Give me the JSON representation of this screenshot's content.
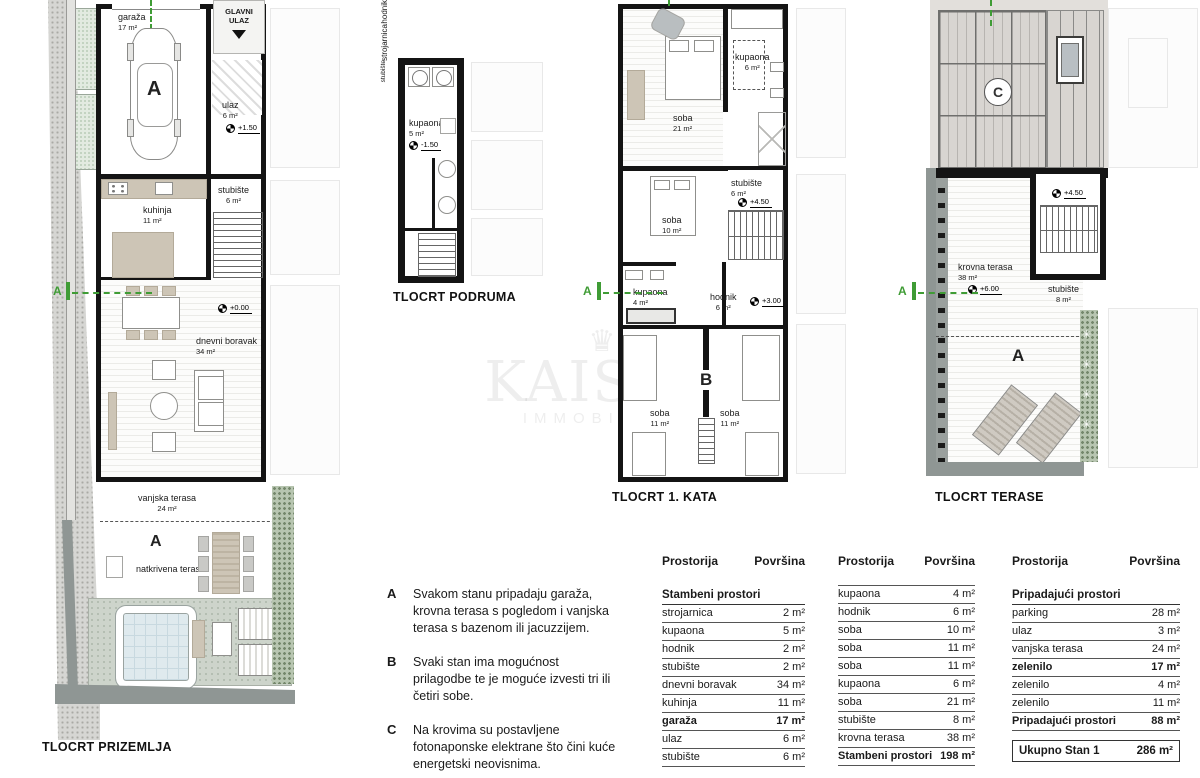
{
  "watermark": {
    "brand": "KAISER",
    "sub": "IMMOBILIEN",
    "crown": "♛"
  },
  "section_label": "A",
  "plans": {
    "prizemlje": {
      "caption": "TLOCRT PRIZEMLJA",
      "glavni_ulaz_line1": "GLAVNI",
      "glavni_ulaz_line2": "ULAZ",
      "unit_label": "A",
      "garaza_name": "garaža",
      "garaza_area": "17 m²",
      "ulaz_name": "ulaz",
      "ulaz_area": "6 m²",
      "ulaz_level": "+1.50",
      "stubiste_name": "stubište",
      "stubiste_area": "6 m²",
      "kuhinja_name": "kuhinja",
      "kuhinja_area": "11 m²",
      "dnevni_name": "dnevni boravak",
      "dnevni_area": "34 m²",
      "dnevni_level": "+0.00",
      "vanjska_name": "vanjska terasa",
      "vanjska_area": "24 m²",
      "natkrivena_name": "natkrivena terasa",
      "terasa_unit_label": "A"
    },
    "podrum": {
      "caption": "TLOCRT PODRUMA",
      "kupaona_name": "kupaona",
      "kupaona_area": "5 m²",
      "kupaona_level": "-1.50",
      "hodnik_name": "hodnik",
      "strojarnica_name": "strojarnica",
      "stubiste_name": "stubište"
    },
    "kat1": {
      "caption": "TLOCRT 1. KATA",
      "soba21_name": "soba",
      "soba21_area": "21 m²",
      "kupaona6_name": "kupaona",
      "kupaona6_area": "6 m²",
      "soba10_name": "soba",
      "soba10_area": "10 m²",
      "stubiste_name": "stubište",
      "stubiste_area": "6 m²",
      "stubiste_level": "+4.50",
      "kupaona4_name": "kupaona",
      "kupaona4_area": "4 m²",
      "hodnik_name": "hodnik",
      "hodnik_area": "6 m²",
      "hodnik_level": "+3.00",
      "variant_label": "B",
      "soba11a_name": "soba",
      "soba11a_area": "11 m²",
      "soba11b_name": "soba",
      "soba11b_area": "11 m²"
    },
    "terasa": {
      "caption": "TLOCRT TERASE",
      "roof_label": "C",
      "stubiste_level": "+4.50",
      "krovna_name": "krovna terasa",
      "krovna_area": "38 m²",
      "krovna_level": "+6.00",
      "stubiste_name": "stubište",
      "stubiste_area": "8 m²",
      "unit_label": "A"
    }
  },
  "notes": [
    {
      "key": "A",
      "text": "Svakom stanu pripadaju garaža, krovna terasa s pogledom i vanjska terasa s bazenom ili jacuzzijem."
    },
    {
      "key": "B",
      "text": "Svaki stan ima mogućnost prilagodbe te je moguće izvesti tri ili četiri sobe."
    },
    {
      "key": "C",
      "text": "Na krovima su postavljene fotonaponske elektrane što čini kuće energetski neovisnima."
    }
  ],
  "tables": [
    {
      "col1": "Prostorija",
      "col2": "Površina",
      "section": "Stambeni prostori",
      "rows": [
        {
          "label": "strojarnica",
          "value": "2 m²"
        },
        {
          "label": "kupaona",
          "value": "5 m²"
        },
        {
          "label": "hodnik",
          "value": "2 m²"
        },
        {
          "label": "stubište",
          "value": "2 m²"
        },
        {
          "label": "dnevni boravak",
          "value": "34 m²"
        },
        {
          "label": "kuhinja",
          "value": "11 m²"
        },
        {
          "label": "garaža",
          "value": "17 m²",
          "bold": true
        },
        {
          "label": "ulaz",
          "value": "6 m²"
        },
        {
          "label": "stubište",
          "value": "6 m²"
        }
      ]
    },
    {
      "col1": "Prostorija",
      "col2": "Površina",
      "rows": [
        {
          "label": "kupaona",
          "value": "4 m²"
        },
        {
          "label": "hodnik",
          "value": "6 m²"
        },
        {
          "label": "soba",
          "value": "10 m²"
        },
        {
          "label": "soba",
          "value": "11 m²"
        },
        {
          "label": "soba",
          "value": "11 m²"
        },
        {
          "label": "kupaona",
          "value": "6 m²"
        },
        {
          "label": "soba",
          "value": "21 m²"
        },
        {
          "label": "stubište",
          "value": "8 m²"
        },
        {
          "label": "krovna terasa",
          "value": "38 m²"
        },
        {
          "label": "Stambeni prostori",
          "value": "198 m²",
          "bold": true
        }
      ]
    },
    {
      "col1": "Prostorija",
      "col2": "Površina",
      "section": "Pripadajući prostori",
      "rows": [
        {
          "label": "parking",
          "value": "28 m²"
        },
        {
          "label": "ulaz",
          "value": "3 m²"
        },
        {
          "label": "vanjska terasa",
          "value": "24 m²"
        },
        {
          "label": "zelenilo",
          "value": "17 m²",
          "bold": true
        },
        {
          "label": "zelenilo",
          "value": "4 m²"
        },
        {
          "label": "zelenilo",
          "value": "11 m²"
        },
        {
          "label": "Pripadajući prostori",
          "value": "88 m²",
          "bold": true
        }
      ],
      "total": {
        "label": "Ukupno Stan 1",
        "value": "286 m²"
      }
    }
  ],
  "colors": {
    "accent_green": "#3f9c35",
    "wall": "#141414",
    "terrace": "#cdd4cb",
    "pool": "#dfeaee"
  }
}
